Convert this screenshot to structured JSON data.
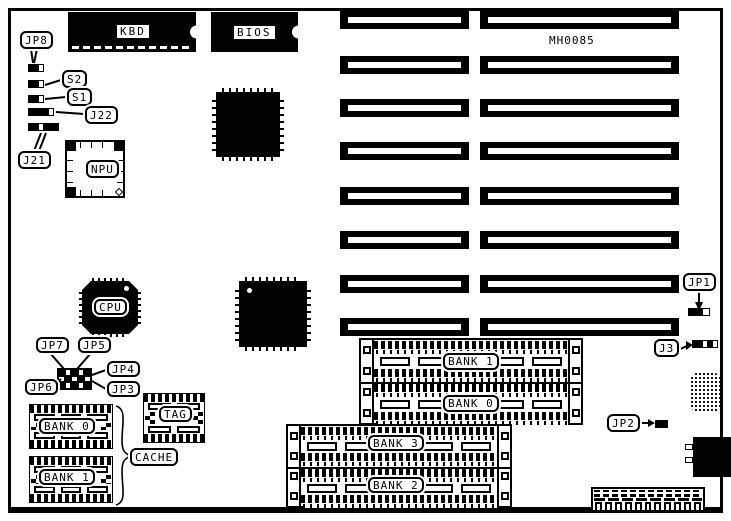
{
  "board": {
    "part_number": "MH0085"
  },
  "chips": {
    "kbd": "KBD",
    "bios": "BIOS",
    "npu": "NPU",
    "cpu": "CPU",
    "tag": "TAG"
  },
  "jumpers": {
    "jp8": "JP8",
    "s2": "S2",
    "s1": "S1",
    "j22": "J22",
    "j21": "J21",
    "jp7": "JP7",
    "jp5": "JP5",
    "jp4": "JP4",
    "jp3": "JP3",
    "jp6": "JP6",
    "jp1": "JP1",
    "j3": "J3",
    "jp2": "JP2"
  },
  "memory": {
    "simm": {
      "bank1": "BANK 1",
      "bank0": "BANK 0",
      "bank3": "BANK 3",
      "bank2": "BANK 2"
    },
    "cache": {
      "bank0": "BANK 0",
      "bank1": "BANK 1",
      "group_label": "CACHE"
    }
  }
}
